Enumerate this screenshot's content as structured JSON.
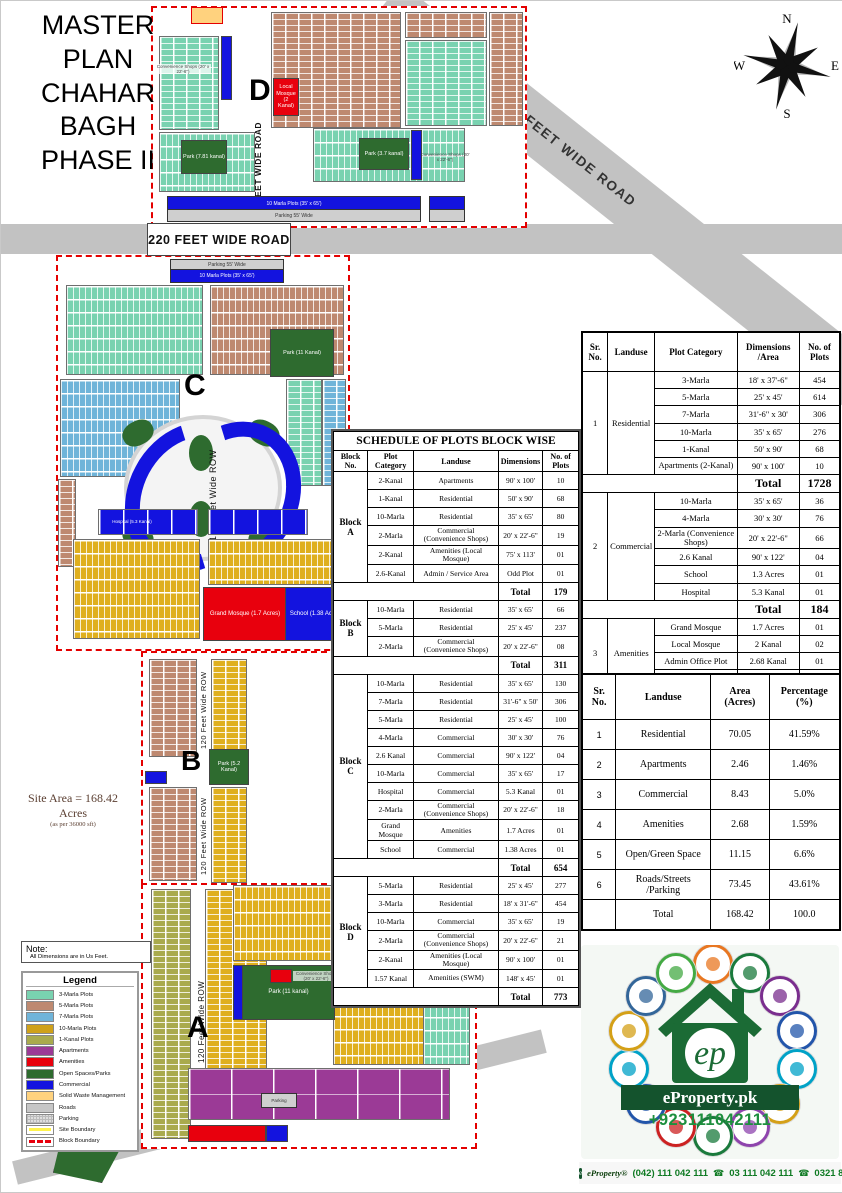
{
  "title": {
    "line1": "MASTER PLAN",
    "line2": "CHAHAR BAGH",
    "line3": "PHASE II"
  },
  "compass": {
    "n": "N",
    "e": "E",
    "s": "S",
    "w": "W"
  },
  "map": {
    "road_300": "300 FEET WIDE ROAD",
    "road_220": "220 FEET WIDE ROAD",
    "road_80": "80 FEET WIDE ROAD",
    "row_120": "120 Feet Wide ROW",
    "theri_road": "Theri Road",
    "parking_55": "Parking 55' Wide",
    "ten_marla_strip": "10 Marla Plots (35' x 65')",
    "block_a": "A",
    "block_b": "B",
    "block_c": "C",
    "block_d": "D",
    "site_area_1": "Site Area = 168.42",
    "site_area_2": "Acres",
    "site_area_3": "(as per 36000 sft)",
    "park_d_left": "Park (7.81 kanal)",
    "park_d_right": "Park (3.7 kanal)",
    "park_c": "Park (11 Kanal)",
    "park_b": "Park (5.2 Kanal)",
    "park_a": "Park (11 kanal)",
    "park_bottom": "Park (0.72 kanal)",
    "grand_mosque": "Grand Mosque (1.7 Acres)",
    "school": "School (1.38 Acres)",
    "hospital": "Hospital (5.3 Kanal)",
    "local_mosque": "Local Mosque (2 Kanal)",
    "convenience_shops": "Convenience Shops (20' x 22'-6\")",
    "parking_small": "Parking"
  },
  "schedule_table": {
    "title": "SCHEDULE OF PLOTS BLOCK WISE",
    "headers": [
      "Block No.",
      "Plot Category",
      "Landuse",
      "Dimensions",
      "No. of Plots"
    ],
    "total_label": "Total",
    "blocks": [
      {
        "name": "Block A",
        "total": "179",
        "rows": [
          [
            "2-Kanal",
            "Apartments",
            "90' x 100'",
            "10"
          ],
          [
            "1-Kanal",
            "Residential",
            "50' x 90'",
            "68"
          ],
          [
            "10-Marla",
            "Residential",
            "35' x 65'",
            "80"
          ],
          [
            "2-Marla",
            "Commercial (Convenience Shops)",
            "20' x 22'-6\"",
            "19"
          ],
          [
            "2-Kanal",
            "Amenities (Local Mosque)",
            "75' x 113'",
            "01"
          ],
          [
            "2.6-Kanal",
            "Admin / Service Area",
            "Odd Plot",
            "01"
          ]
        ]
      },
      {
        "name": "Block B",
        "total": "311",
        "rows": [
          [
            "10-Marla",
            "Residential",
            "35' x 65'",
            "66"
          ],
          [
            "5-Marla",
            "Residential",
            "25' x 45'",
            "237"
          ],
          [
            "2-Marla",
            "Commercial (Convenience Shops)",
            "20' x 22'-6\"",
            "08"
          ]
        ]
      },
      {
        "name": "Block C",
        "total": "654",
        "rows": [
          [
            "10-Marla",
            "Residential",
            "35' x 65'",
            "130"
          ],
          [
            "7-Marla",
            "Residential",
            "31'-6\" x 50'",
            "306"
          ],
          [
            "5-Marla",
            "Residential",
            "25' x 45'",
            "100"
          ],
          [
            "4-Marla",
            "Commercial",
            "30' x 30'",
            "76"
          ],
          [
            "2.6 Kanal",
            "Commercial",
            "90' x 122'",
            "04"
          ],
          [
            "10-Marla",
            "Commercial",
            "35' x 65'",
            "17"
          ],
          [
            "Hospital",
            "Commercial",
            "5.3 Kanal",
            "01"
          ],
          [
            "2-Marla",
            "Commercial (Convenience Shops)",
            "20' x 22'-6\"",
            "18"
          ],
          [
            "Grand Mosque",
            "Amenities",
            "1.7 Acres",
            "01"
          ],
          [
            "School",
            "Commercial",
            "1.38 Acres",
            "01"
          ]
        ]
      },
      {
        "name": "Block D",
        "total": "773",
        "rows": [
          [
            "5-Marla",
            "Residential",
            "25' x 45'",
            "277"
          ],
          [
            "3-Marla",
            "Residential",
            "18' x 31'-6\"",
            "454"
          ],
          [
            "10-Marla",
            "Commercial",
            "35' x 65'",
            "19"
          ],
          [
            "2-Marla",
            "Commercial (Convenience Shops)",
            "20' x 22'-6\"",
            "21"
          ],
          [
            "2-Kanal",
            "Amenities (Local Mosque)",
            "90' x 100'",
            "01"
          ],
          [
            "1.57 Kanal",
            "Amenities (SWM)",
            "148' x 45'",
            "01"
          ]
        ]
      }
    ]
  },
  "landuse_table": {
    "headers": [
      "Sr. No.",
      "Landuse",
      "Plot Category",
      "Dimensions /Area",
      "No. of Plots"
    ],
    "total_label": "Total",
    "sections": [
      {
        "sr": "1",
        "landuse": "Residential",
        "total": "1728",
        "rows": [
          [
            "3-Marla",
            "18' x 37'-6\"",
            "454"
          ],
          [
            "5-Marla",
            "25' x 45'",
            "614"
          ],
          [
            "7-Marla",
            "31'-6\" x 30'",
            "306"
          ],
          [
            "10-Marla",
            "35' x 65'",
            "276"
          ],
          [
            "1-Kanal",
            "50' x 90'",
            "68"
          ],
          [
            "Apartments (2-Kanal)",
            "90' x 100'",
            "10"
          ]
        ]
      },
      {
        "sr": "2",
        "landuse": "Commercial",
        "total": "184",
        "rows": [
          [
            "10-Marla",
            "35' x 65'",
            "36"
          ],
          [
            "4-Marla",
            "30' x 30'",
            "76"
          ],
          [
            "2-Marla (Convenience Shops)",
            "20' x 22'-6\"",
            "66"
          ],
          [
            "2.6 Kanal",
            "90' x 122'",
            "04"
          ],
          [
            "School",
            "1.3 Acres",
            "01"
          ],
          [
            "Hospital",
            "5.3 Kanal",
            "01"
          ]
        ]
      },
      {
        "sr": "3",
        "landuse": "Amenities",
        "total": "05",
        "rows": [
          [
            "Grand Mosque",
            "1.7 Acres",
            "01"
          ],
          [
            "Local Mosque",
            "2 Kanal",
            "02"
          ],
          [
            "Admin Office Plot",
            "2.68 Kanal",
            "01"
          ],
          [
            "SWM",
            "1.57 Kanal",
            "01"
          ]
        ]
      }
    ]
  },
  "area_table": {
    "headers": [
      "Sr. No.",
      "Landuse",
      "Area (Acres)",
      "Percentage (%)"
    ],
    "rows": [
      [
        "1",
        "Residential",
        "70.05",
        "41.59%"
      ],
      [
        "2",
        "Apartments",
        "2.46",
        "1.46%"
      ],
      [
        "3",
        "Commercial",
        "8.43",
        "5.0%"
      ],
      [
        "4",
        "Amenities",
        "2.68",
        "1.59%"
      ],
      [
        "5",
        "Open/Green Space",
        "11.15",
        "6.6%"
      ],
      [
        "6",
        "Roads/Streets /Parking",
        "73.45",
        "43.61%"
      ]
    ],
    "total": [
      "",
      "Total",
      "168.42",
      "100.0"
    ]
  },
  "note": {
    "title": "Note:",
    "text": "All Dimensions are in Us Feet."
  },
  "legend": {
    "title": "Legend",
    "items": [
      {
        "label": "3-Marla Plots",
        "color": "#79D2B0",
        "style": "solid"
      },
      {
        "label": "5-Marla Plots",
        "color": "#BE8970",
        "style": "solid"
      },
      {
        "label": "7-Marla Plots",
        "color": "#6FB4D9",
        "style": "solid"
      },
      {
        "label": "10-Marla Plots",
        "color": "#CFA11A",
        "style": "solid"
      },
      {
        "label": "1-Kanal Plots",
        "color": "#A9AA4D",
        "style": "solid"
      },
      {
        "label": "Apartments",
        "color": "#9B3A96",
        "style": "solid"
      },
      {
        "label": "Amenities",
        "color": "#E8000D",
        "style": "solid"
      },
      {
        "label": "Open Spaces/Parks",
        "color": "#2E6B2F",
        "style": "solid"
      },
      {
        "label": "Commercial",
        "color": "#1313DF",
        "style": "solid"
      },
      {
        "label": "Solid Waste Management",
        "color": "#FFD27E",
        "style": "solid"
      },
      {
        "label": "Roads",
        "color": "#C6C6C6",
        "style": "solid"
      },
      {
        "label": "Parking",
        "color": "#DEDEDE",
        "style": "dots"
      },
      {
        "label": "Site Boundary",
        "color": "#FFF34D",
        "style": "line"
      },
      {
        "label": "Block Boundary",
        "color": "#E8000D",
        "style": "dash"
      }
    ]
  },
  "branding": {
    "name": "eProperty.pk",
    "logo_monogram": "ep",
    "phone": "+923111042111",
    "footer_brand": "eProperty®",
    "footer_phone1": "(042) 111 042 111",
    "footer_phone2": "03 111 042 111",
    "footer_phone3": "0321 8469951",
    "phone_icon": "☎",
    "ring_colors": [
      "#e87722",
      "#1a7a3c",
      "#7a2e8e",
      "#2255aa",
      "#00a2c7",
      "#d4a017",
      "#8e44ad",
      "#1a7a3c",
      "#cc2222",
      "#2255aa",
      "#00a2c7",
      "#d4a017",
      "#336699",
      "#44aa44"
    ]
  }
}
